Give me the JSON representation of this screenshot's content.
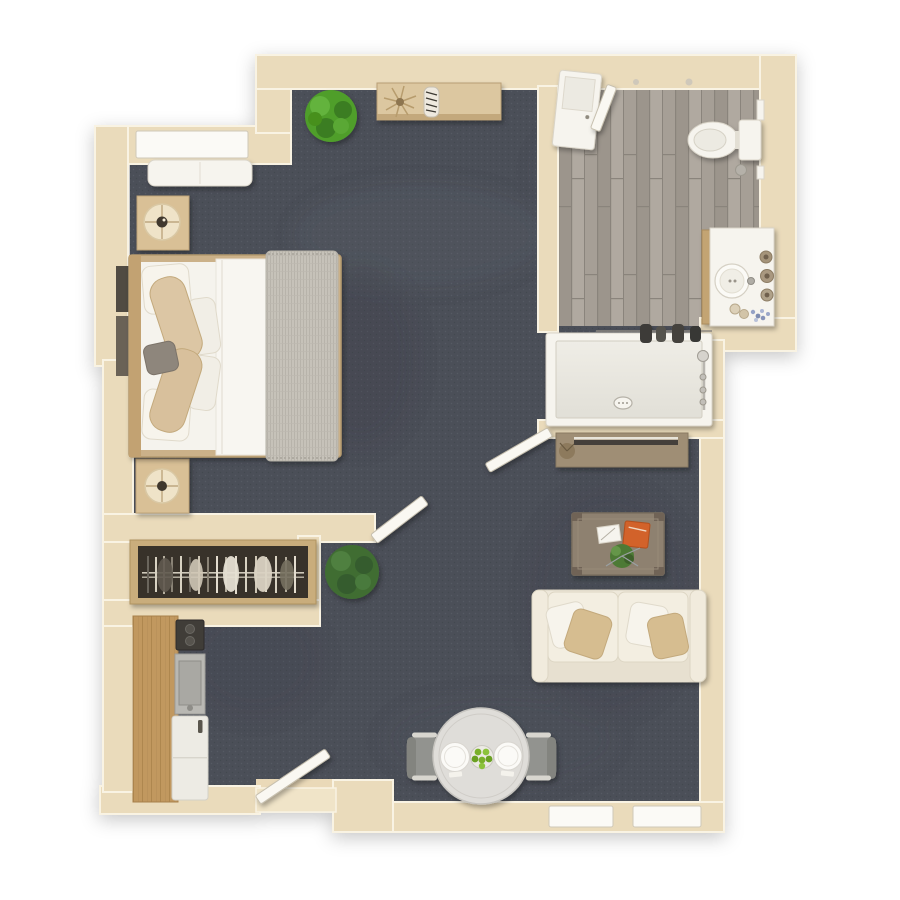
{
  "meta": {
    "kind": "3d-floor-plan-render",
    "view": "top-down",
    "unit_type": "studio-apartment",
    "background": "#ffffff",
    "visible_text": ""
  },
  "colors": {
    "carpet": "#4b4f58",
    "carpetLight": "#5b5f69",
    "carpetDark": "#3d414a",
    "wall": "#eadbbb",
    "wallTrim": "#f9f3e3",
    "wallEdge": "#c8b088",
    "woodFloor": "#a39c93",
    "woodFloorDark": "#8a847b",
    "woodFloorLight": "#b1aaa1",
    "fixtureWhite": "#f6f4ee",
    "doorWhite": "#faf8f2",
    "furnitureWood": "#d9c096",
    "consoleWood": "#9f8e74",
    "coffeeWood": "#8e8170",
    "counterWood": "#c1985f",
    "sofaCream": "#eee8da",
    "pillowTan": "#d6bd90",
    "bedding": "#f5f3ed",
    "blanketGray": "#c6c2b9",
    "accentGray": "#8e867c",
    "plantBright": "#4f9e2c",
    "plantDark": "#3f6d33",
    "pampas": "#b79c6d",
    "closetDark": "#37322b",
    "chairGray": "#92938f",
    "tableTop": "#dfddd9",
    "fruitGreen": "#7ab02a",
    "bookOrange": "#d2622a",
    "steel": "#b9b8b3",
    "darkAppliance": "#3f3d39"
  },
  "rooms": {
    "bedroom": {
      "items": [
        "double-bed",
        "gray-knit-throw",
        "white-pillows",
        "beige-bolster-pillows",
        "nightstand-with-lamp",
        "second-nightstand-with-lamp",
        "window-bench",
        "window",
        "wall-art"
      ]
    },
    "closet": {
      "items": [
        "hanging-rod",
        "clothes-hangers",
        "garments"
      ]
    },
    "kitchen": {
      "items": [
        "counter",
        "cooktop",
        "sink",
        "refrigerator"
      ]
    },
    "bathroom": {
      "items": [
        "toilet",
        "vanity-sink",
        "soap-jars",
        "shower-tub",
        "shower-fixture",
        "towels",
        "storage-cabinet",
        "towel-bars",
        "wood-plank-floor"
      ]
    },
    "living": {
      "items": [
        "console-table",
        "pampas-decor",
        "zebra-decor",
        "potted-plant-corner",
        "potted-plant-closet",
        "tv-console",
        "coffee-table",
        "notebook",
        "orange-book",
        "table-plant",
        "loveseat-sofa"
      ]
    },
    "dining": {
      "items": [
        "round-table",
        "plate-left",
        "plate-right",
        "fruit-bowl",
        "chair-left",
        "chair-right"
      ]
    },
    "doors": [
      "entry-door",
      "bedroom-door",
      "bathroom-lower-door",
      "bathroom-upper-door"
    ]
  }
}
